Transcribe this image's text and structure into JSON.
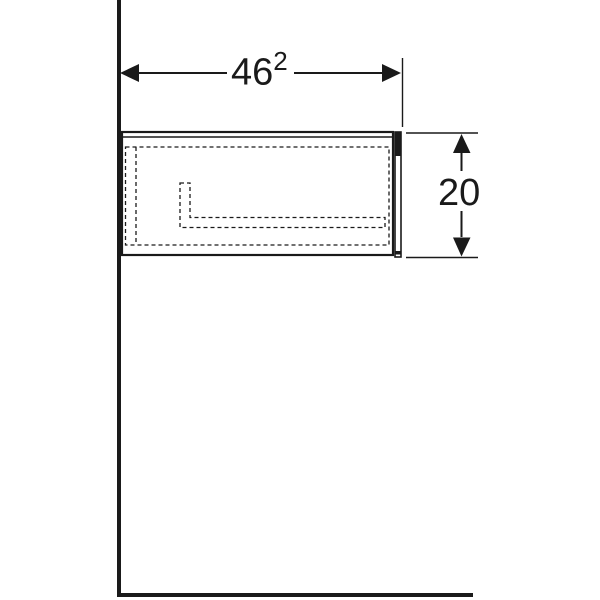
{
  "drawing": {
    "kind": "technical-dimension-drawing",
    "colors": {
      "line": "#1a1a1a",
      "background": "#ffffff"
    },
    "dimensions": {
      "width": {
        "value": "46",
        "superscript": "2"
      },
      "height": {
        "value": "20"
      }
    }
  }
}
